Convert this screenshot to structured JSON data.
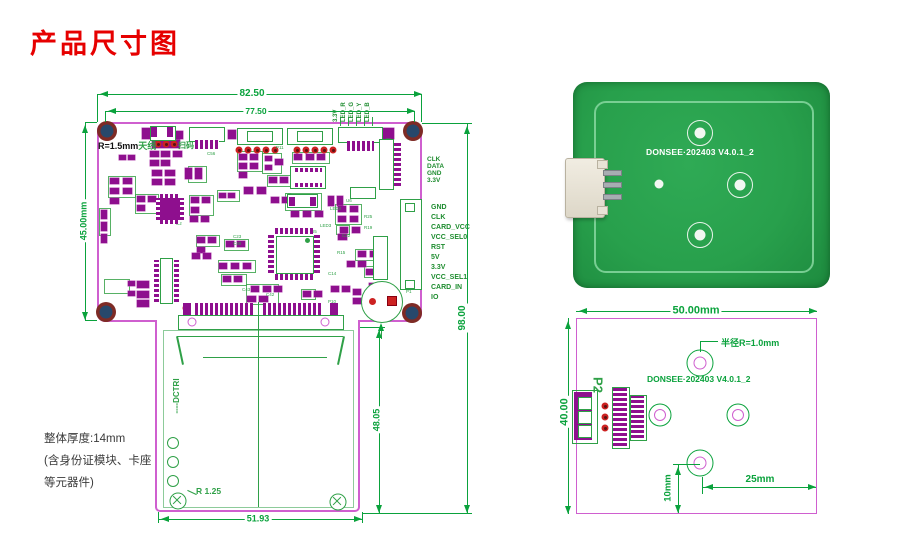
{
  "title": "产品尺寸图",
  "main_drawing": {
    "dims": {
      "w_outer": "82.50",
      "w_inner": "77.50",
      "h_left": "45.00mm",
      "h_right": "98.00",
      "card_h": "48.05",
      "card_w": "51.93"
    },
    "labels": {
      "corner_r": "R=1.5mm",
      "antenna": "天线",
      "scan": "扫码",
      "card_slot": "----DCTRI",
      "hole_r": "R 1.25",
      "beep": "BEEP"
    },
    "led_labels": [
      "3.3V",
      "LED_R",
      "LED_G",
      "LED_Y",
      "LED_B"
    ],
    "pin_group1": [
      "CLK",
      "DATA",
      "GND",
      "3.3V"
    ],
    "pin_group2": [
      "GND",
      "CLK",
      "CARD_VCC",
      "VCC_SEL0",
      "RST",
      "5V",
      "3.3V",
      "VCC_SEL1",
      "CARD_IN",
      "IO"
    ],
    "note_lines": [
      "整体厚度:14mm",
      "(含身份证模块、卡座",
      "等元器件)"
    ]
  },
  "photo_board": {
    "silkscreen": "DONSEE·202403 V4.0.1_2"
  },
  "dim_drawing": {
    "width": "50.00mm",
    "height": "40.00",
    "radius_note": "半径R=1.0mm",
    "silkscreen": "DONSEE·202403 V4.0.1_2",
    "connector": "P2",
    "offset_v": "10mm",
    "offset_h": "25mm"
  },
  "colors": {
    "title_red": "#e60000",
    "dimension_green": "#0aa23c",
    "silkscreen_green": "#2fa047",
    "component_magenta": "#8e0f8e",
    "board_outline_pink": "#cf5fcf",
    "pcb_green": "#2aa04f",
    "trace_green": "#82d49b"
  },
  "components": {
    "smd": [
      [
        150,
        151,
        9,
        6
      ],
      [
        161,
        151,
        9,
        6
      ],
      [
        173,
        151,
        9,
        6
      ],
      [
        150,
        160,
        9,
        6
      ],
      [
        161,
        160,
        9,
        6
      ],
      [
        152,
        170,
        10,
        6
      ],
      [
        165,
        170,
        10,
        6
      ],
      [
        152,
        179,
        10,
        6
      ],
      [
        165,
        179,
        10,
        6
      ],
      [
        185,
        168,
        7,
        11
      ],
      [
        195,
        168,
        7,
        11
      ],
      [
        119,
        155,
        7,
        5
      ],
      [
        128,
        155,
        7,
        5
      ],
      [
        110,
        178,
        9,
        6
      ],
      [
        123,
        178,
        9,
        6
      ],
      [
        110,
        188,
        9,
        6
      ],
      [
        123,
        188,
        9,
        6
      ],
      [
        110,
        198,
        9,
        6
      ],
      [
        101,
        210,
        6,
        9
      ],
      [
        101,
        222,
        6,
        9
      ],
      [
        101,
        234,
        6,
        9
      ],
      [
        137,
        196,
        8,
        6
      ],
      [
        148,
        196,
        8,
        6
      ],
      [
        137,
        205,
        8,
        6
      ],
      [
        191,
        197,
        8,
        6
      ],
      [
        202,
        197,
        8,
        6
      ],
      [
        191,
        207,
        8,
        6
      ],
      [
        219,
        193,
        7,
        5
      ],
      [
        228,
        193,
        7,
        5
      ],
      [
        190,
        216,
        8,
        6
      ],
      [
        201,
        216,
        8,
        6
      ],
      [
        239,
        154,
        8,
        6
      ],
      [
        250,
        154,
        8,
        6
      ],
      [
        239,
        163,
        8,
        6
      ],
      [
        250,
        163,
        8,
        6
      ],
      [
        239,
        172,
        8,
        6
      ],
      [
        244,
        187,
        9,
        7
      ],
      [
        257,
        187,
        9,
        7
      ],
      [
        265,
        156,
        7,
        5
      ],
      [
        265,
        165,
        7,
        5
      ],
      [
        275,
        159,
        8,
        6
      ],
      [
        269,
        177,
        8,
        6
      ],
      [
        280,
        177,
        8,
        6
      ],
      [
        294,
        154,
        8,
        6
      ],
      [
        306,
        154,
        8,
        6
      ],
      [
        317,
        154,
        8,
        6
      ],
      [
        271,
        197,
        8,
        6
      ],
      [
        282,
        197,
        8,
        6
      ],
      [
        291,
        211,
        8,
        6
      ],
      [
        303,
        211,
        8,
        6
      ],
      [
        315,
        211,
        8,
        6
      ],
      [
        328,
        196,
        6,
        10
      ],
      [
        337,
        196,
        6,
        10
      ],
      [
        338,
        206,
        8,
        6
      ],
      [
        350,
        206,
        8,
        6
      ],
      [
        338,
        216,
        8,
        6
      ],
      [
        350,
        216,
        8,
        6
      ],
      [
        340,
        227,
        8,
        6
      ],
      [
        352,
        227,
        8,
        6
      ],
      [
        338,
        234,
        9,
        6
      ],
      [
        358,
        251,
        8,
        6
      ],
      [
        370,
        251,
        8,
        6
      ],
      [
        358,
        261,
        8,
        6
      ],
      [
        347,
        261,
        8,
        6
      ],
      [
        366,
        269,
        8,
        6
      ],
      [
        376,
        269,
        8,
        6
      ],
      [
        197,
        237,
        8,
        6
      ],
      [
        208,
        237,
        8,
        6
      ],
      [
        197,
        247,
        8,
        6
      ],
      [
        226,
        241,
        8,
        6
      ],
      [
        237,
        241,
        8,
        6
      ],
      [
        192,
        253,
        8,
        6
      ],
      [
        203,
        253,
        8,
        6
      ],
      [
        219,
        263,
        8,
        6
      ],
      [
        231,
        263,
        8,
        6
      ],
      [
        243,
        263,
        8,
        6
      ],
      [
        223,
        276,
        8,
        6
      ],
      [
        234,
        276,
        8,
        6
      ],
      [
        251,
        286,
        8,
        6
      ],
      [
        263,
        286,
        8,
        6
      ],
      [
        274,
        286,
        8,
        6
      ],
      [
        247,
        296,
        9,
        6
      ],
      [
        259,
        296,
        9,
        6
      ],
      [
        303,
        291,
        8,
        6
      ],
      [
        314,
        291,
        8,
        6
      ],
      [
        331,
        286,
        8,
        6
      ],
      [
        342,
        286,
        8,
        6
      ],
      [
        353,
        289,
        8,
        6
      ],
      [
        353,
        298,
        8,
        6
      ],
      [
        369,
        283,
        7,
        5
      ],
      [
        377,
        283,
        7,
        5
      ],
      [
        137,
        281,
        12,
        7
      ],
      [
        137,
        291,
        12,
        7
      ],
      [
        137,
        300,
        12,
        7
      ],
      [
        128,
        281,
        7,
        5
      ],
      [
        128,
        291,
        7,
        5
      ],
      [
        152,
        138,
        28,
        10
      ],
      [
        142,
        128,
        11,
        11
      ],
      [
        170,
        131,
        13,
        8
      ],
      [
        228,
        130,
        8,
        9
      ],
      [
        382,
        128,
        12,
        11
      ]
    ],
    "green_boxes": [
      [
        108,
        176,
        26,
        20
      ],
      [
        135,
        194,
        22,
        18
      ],
      [
        99,
        208,
        10,
        26
      ],
      [
        188,
        166,
        17,
        15
      ],
      [
        189,
        195,
        23,
        19
      ],
      [
        217,
        190,
        21,
        10
      ],
      [
        237,
        151,
        24,
        19
      ],
      [
        262,
        153,
        18,
        19
      ],
      [
        267,
        175,
        23,
        10
      ],
      [
        292,
        152,
        36,
        10
      ],
      [
        335,
        204,
        25,
        19
      ],
      [
        336,
        225,
        12,
        8
      ],
      [
        355,
        249,
        25,
        10
      ],
      [
        364,
        266,
        22,
        10
      ],
      [
        246,
        284,
        31,
        19
      ],
      [
        301,
        289,
        13,
        9
      ],
      [
        104,
        279,
        24,
        13
      ],
      [
        218,
        260,
        36,
        11
      ],
      [
        221,
        274,
        24,
        10
      ],
      [
        285,
        193,
        35,
        16
      ],
      [
        196,
        235,
        22,
        10
      ],
      [
        224,
        239,
        23,
        10
      ]
    ],
    "red_dots": [
      [
        239,
        150
      ],
      [
        248,
        150
      ],
      [
        257,
        150
      ],
      [
        266,
        150
      ],
      [
        275,
        150
      ],
      [
        297,
        150
      ],
      [
        306,
        150
      ],
      [
        315,
        150
      ],
      [
        324,
        150
      ],
      [
        333,
        150
      ],
      [
        385,
        146
      ],
      [
        385,
        155
      ],
      [
        385,
        164
      ],
      [
        385,
        173
      ],
      [
        385,
        182
      ],
      [
        379,
        242
      ],
      [
        379,
        252
      ],
      [
        379,
        262
      ],
      [
        379,
        272
      ],
      [
        158,
        144
      ],
      [
        166,
        144
      ],
      [
        174,
        144
      ],
      [
        186,
        308
      ],
      [
        334,
        308
      ]
    ],
    "refs": [
      [
        "C56",
        207,
        152
      ],
      [
        "P11",
        276,
        146
      ],
      [
        "U3",
        311,
        166
      ],
      [
        "U2",
        176,
        222
      ],
      [
        "Y2",
        286,
        193
      ],
      [
        "U6",
        346,
        199
      ],
      [
        "LED2",
        330,
        207
      ],
      [
        "LED3",
        320,
        224
      ],
      [
        "R25",
        364,
        215
      ],
      [
        "R19",
        364,
        226
      ],
      [
        "C22",
        342,
        234
      ],
      [
        "U5",
        311,
        230
      ],
      [
        "R15",
        337,
        251
      ],
      [
        "C14",
        328,
        272
      ],
      [
        "C23",
        233,
        235
      ],
      [
        "C40",
        233,
        242
      ],
      [
        "C43",
        242,
        288
      ],
      [
        "C42",
        266,
        293
      ],
      [
        "P10",
        328,
        300
      ],
      [
        "P1",
        406,
        290
      ],
      [
        "P2",
        386,
        138
      ],
      [
        "P3",
        380,
        236
      ]
    ],
    "dim_refs": [
      [
        "C5",
        617,
        384
      ],
      [
        "C3",
        624,
        384
      ],
      [
        "R2",
        611,
        452
      ],
      [
        "C4",
        619,
        452
      ],
      [
        "C6",
        632,
        398
      ],
      [
        "C7",
        639,
        398
      ],
      [
        "C8",
        632,
        444
      ],
      [
        "C10",
        639,
        444
      ]
    ],
    "photo_smd": [
      [
        622,
        163,
        13,
        8
      ],
      [
        622,
        177,
        13,
        8
      ],
      [
        622,
        191,
        13,
        8
      ],
      [
        622,
        205,
        13,
        8
      ],
      [
        639,
        171,
        12,
        7
      ],
      [
        639,
        185,
        12,
        7
      ],
      [
        639,
        199,
        12,
        7
      ]
    ]
  }
}
